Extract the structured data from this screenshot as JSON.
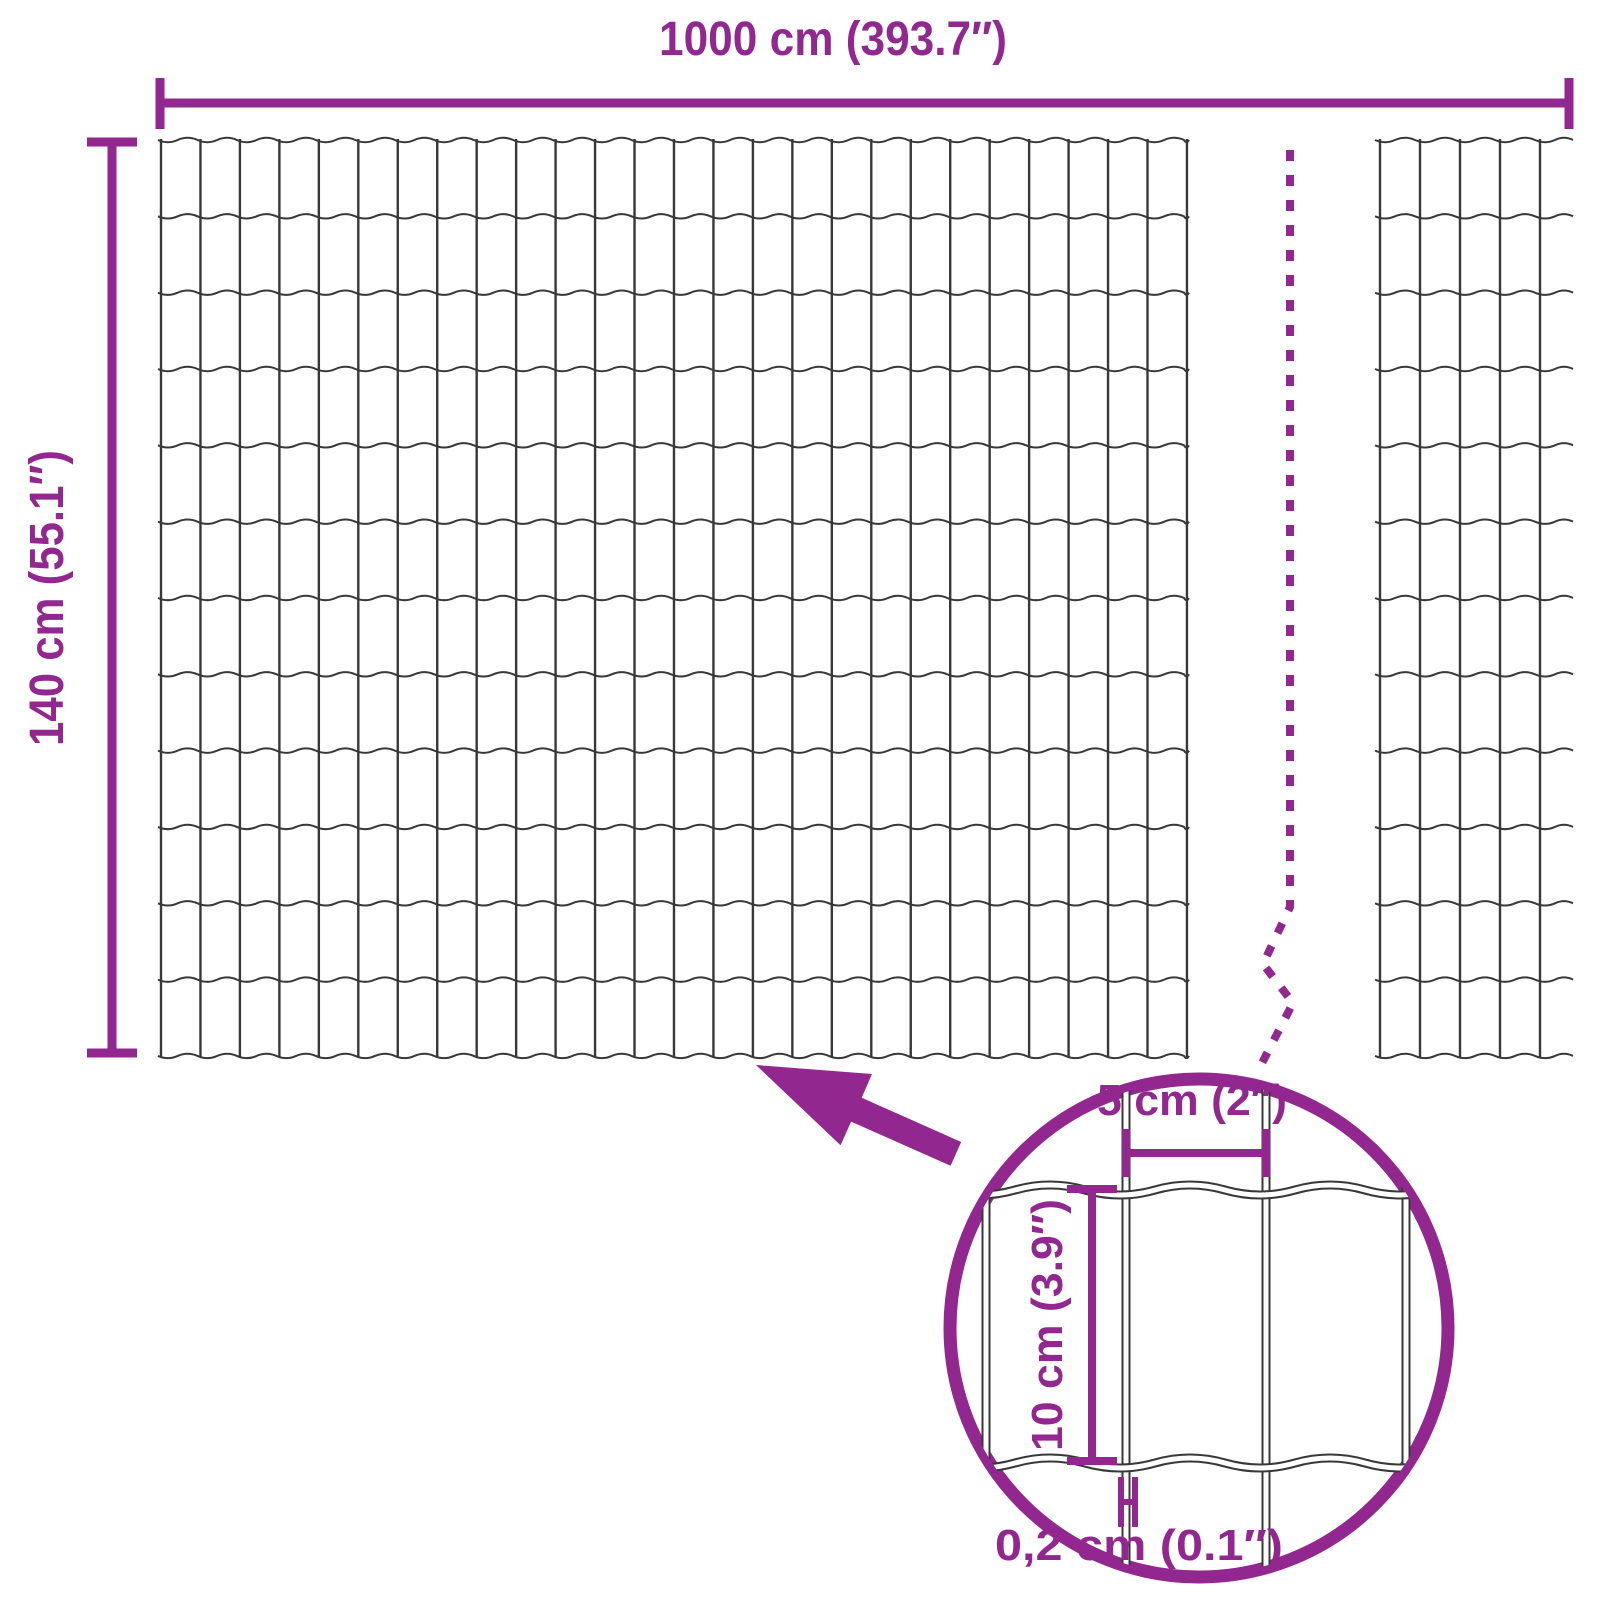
{
  "diagram": {
    "kind": "wire-mesh-fence-dimension-diagram",
    "colors": {
      "accent": "#92278F",
      "wire": "#383838",
      "background": "#FFFFFF"
    },
    "labels": {
      "total_width": "1000 cm (393.7″)",
      "total_height": "140 cm (55.1″)",
      "mesh_cell_width": "5 cm (2″)",
      "mesh_cell_height": "10 cm (3.9″)",
      "wire_thickness": "0,2 cm (0.1″)"
    }
  }
}
